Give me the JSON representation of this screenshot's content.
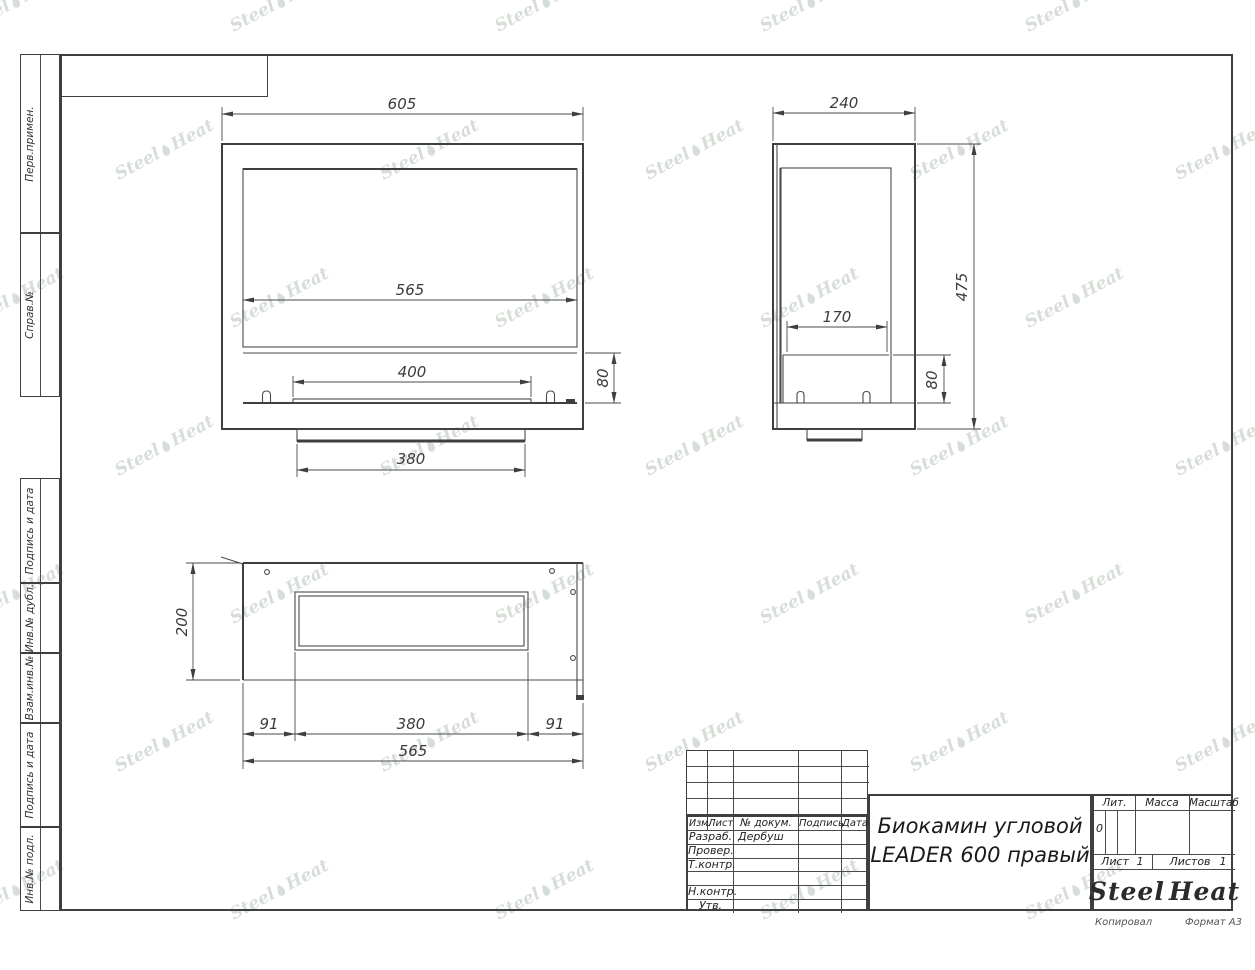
{
  "doc": {
    "title_line1": "Биокамин угловой",
    "title_line2": "LEADER 600 правый",
    "developer": "Дербуш",
    "lit_value": "0",
    "sheet_value": "1",
    "sheets_value": "1"
  },
  "labels": {
    "header_cols": [
      "Изм.",
      "Лист",
      "№ докум.",
      "Подпись",
      "Дата"
    ],
    "row_labels": [
      "Разраб.",
      "Провер.",
      "Т.контр.",
      "",
      "Н.контр.",
      "Утв."
    ],
    "lit": "Лит.",
    "mass": "Масса",
    "scale": "Масштаб",
    "sheet": "Лист",
    "sheets": "Листов",
    "copied": "Копировал",
    "format": "Формат А3"
  },
  "side_labels": [
    "Перв.примен.",
    "Справ.№",
    "Подпись и дата",
    "Инв.№ дубл.",
    "Взам.инв.№",
    "Подпись и дата",
    "Инв.№ подл."
  ],
  "logo": {
    "steel": "Steel",
    "heat": "Heat",
    "flame_color": "#e5242a",
    "text_color": "#2b2b2b"
  },
  "watermark": {
    "steel": "Steel",
    "heat": "Heat",
    "color": "#b8c3b8"
  },
  "views": {
    "front": {
      "dims": {
        "overall_width": "605",
        "inner_width": "565",
        "burner_opening": "400",
        "burner_block_height": "80",
        "base_width": "380"
      }
    },
    "side": {
      "dims": {
        "depth": "240",
        "height": "475",
        "burner_depth": "170",
        "burner_block_height": "80"
      }
    },
    "top": {
      "dims": {
        "depth": "200",
        "left_offset": "91",
        "slot_width": "380",
        "right_offset": "91",
        "overall_width": "565"
      }
    }
  }
}
